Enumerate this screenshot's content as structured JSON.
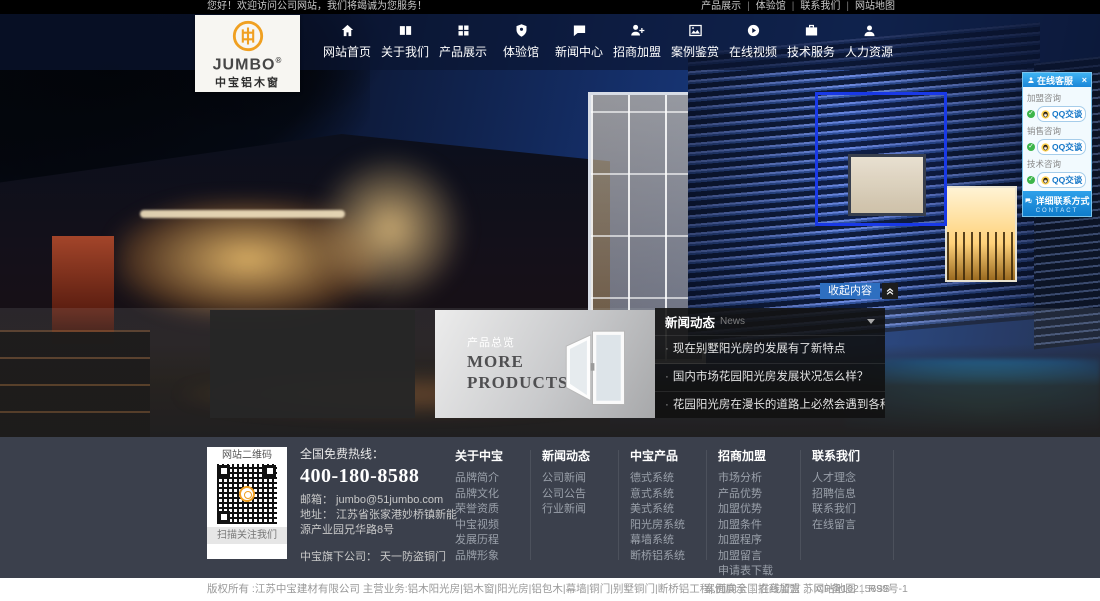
{
  "colors": {
    "accent_orange": "#f0a021",
    "nav_bg": "#0a1430",
    "qq_blue": "#1b86d8",
    "footer_bg": "#3b404c",
    "selection_blue": "#1939e6",
    "collapse_blue": "#2e6fc0"
  },
  "topbar": {
    "welcome": "您好！欢迎访问公司网站，我们将竭诚为您服务！",
    "divider": "|",
    "links": [
      {
        "label": "产品展示"
      },
      {
        "label": "体验馆"
      },
      {
        "label": "联系我们"
      },
      {
        "label": "网站地图"
      }
    ]
  },
  "logo": {
    "name": "JUMBO",
    "reg": "®",
    "subtitle": "中宝铝木窗"
  },
  "nav": {
    "items": [
      {
        "label": "网站首页",
        "icon": "home-icon"
      },
      {
        "label": "关于我们",
        "icon": "book-icon"
      },
      {
        "label": "产品展示",
        "icon": "grid-icon"
      },
      {
        "label": "体验馆",
        "icon": "shield-icon"
      },
      {
        "label": "新闻中心",
        "icon": "chat-icon"
      },
      {
        "label": "招商加盟",
        "icon": "user-plus-icon"
      },
      {
        "label": "案例鉴赏",
        "icon": "photo-icon"
      },
      {
        "label": "在线视频",
        "icon": "play-icon"
      },
      {
        "label": "技术服务",
        "icon": "briefcase-icon"
      },
      {
        "label": "人力资源",
        "icon": "user-icon"
      }
    ]
  },
  "hero": {
    "products_overview": {
      "tag": "产品总览",
      "line1": "MORE",
      "line2": "PRODUCTS"
    },
    "collapse_label": "收起内容",
    "news": {
      "title": "新闻动态",
      "subtitle": "News",
      "bullet": "·",
      "items": [
        "现在别墅阳光房的发展有了新特点",
        "国内市场花园阳光房发展状况怎么样？",
        "花园阳光房在漫长的道路上必然会遇到各种挑战"
      ]
    }
  },
  "qq": {
    "title": "在线客服",
    "close": "×",
    "check": "✓",
    "groups": [
      {
        "label": "加盟咨询",
        "button": "QQ交谈"
      },
      {
        "label": "销售咨询",
        "button": "QQ交谈"
      },
      {
        "label": "技术咨询",
        "button": "QQ交谈"
      }
    ],
    "footer_label": "详细联系方式",
    "footer_sub": "CONTACT"
  },
  "footer": {
    "qr": {
      "title": "网站二维码",
      "caption": "扫描关注我们"
    },
    "contact": {
      "hotline_label": "全国免费热线：",
      "hotline_number": "400-180-8588",
      "email": "邮箱： jumbo@51jumbo.com",
      "address": "地址： 江苏省张家港妙桥镇新能源产业园兄华路8号",
      "subsidiary": "中宝旗下公司： 天一防盗铜门"
    },
    "columns": [
      {
        "title": "关于中宝",
        "links": [
          "品牌简介",
          "品牌文化",
          "荣誉资质",
          "中宝视频",
          "发展历程",
          "品牌形象"
        ]
      },
      {
        "title": "新闻动态",
        "links": [
          "公司新闻",
          "公司公告",
          "行业新闻"
        ]
      },
      {
        "title": "中宝产品",
        "links": [
          "德式系统",
          "意式系统",
          "美式系统",
          "阳光房系统",
          "幕墙系统",
          "断桥铝系统"
        ]
      },
      {
        "title": "招商加盟",
        "links": [
          "市场分析",
          "产品优势",
          "加盟优势",
          "加盟条件",
          "加盟程序",
          "加盟留言",
          "申请表下载"
        ]
      },
      {
        "title": "联系我们",
        "links": [
          "人才理念",
          "招聘信息",
          "联系我们",
          "在线留言"
        ]
      }
    ]
  },
  "bottombar": {
    "copyright": "版权所有 :江苏中宝建材有限公司 主营业务:铝木阳光房|铝木窗|阳光房|铝包木|幕墙|铜门|别墅铜门|断桥铝工程|,面向全国招商加盟 苏ICP备10215699号-1",
    "divider": "|",
    "links": [
      "案例展示",
      "在线留言",
      "网站地图",
      "RSS"
    ]
  }
}
